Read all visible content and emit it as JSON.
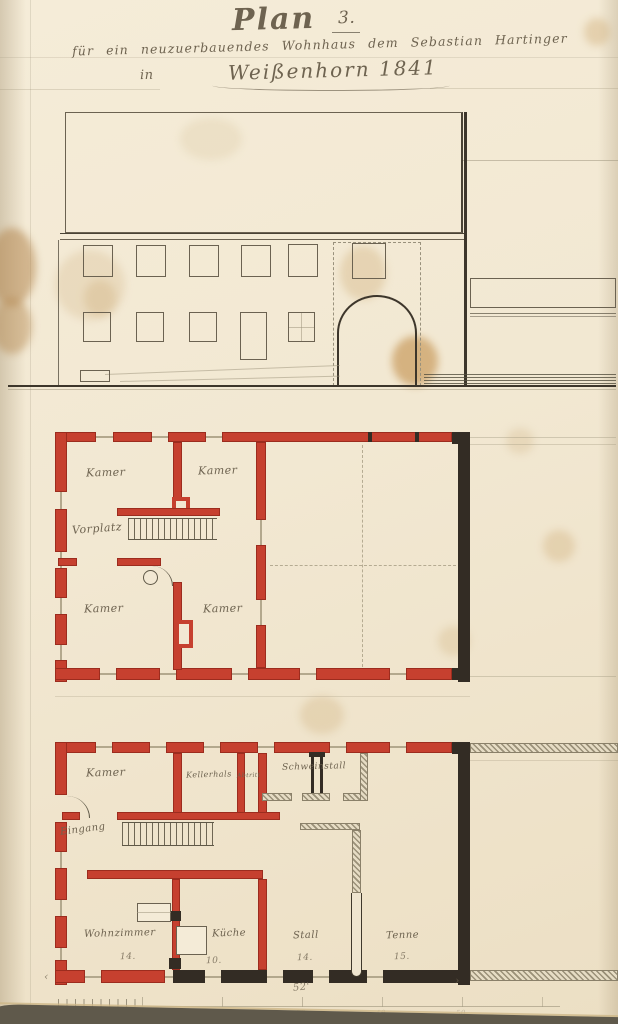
{
  "title": {
    "plan_word": "Plan",
    "plan_number": "3.",
    "subtitle": "für ein neuzuerbauendes Wohnhaus dem Sebastian Hartinger",
    "location_prefix": "in",
    "location": "Weißenhorn 1841"
  },
  "upper_floor_plan": {
    "rooms": {
      "kamer_nw": "Kamer",
      "kamer_ne": "Kamer",
      "vorplatz": "Vorplatz",
      "kamer_sw": "Kamer",
      "kamer_se": "Kamer"
    }
  },
  "ground_floor_plan": {
    "rooms": {
      "kamer": "Kamer",
      "kellerhals": "Kellerhals",
      "abtritt": "Abtritt",
      "schweinstall": "Schweinstall",
      "eingang": "Eingang",
      "wohnzimmer": "Wohnzimmer",
      "kueche": "Küche",
      "stall": "Stall",
      "tenne": "Tenne"
    },
    "dimensions": {
      "wohnzimmer": "14.",
      "kueche": "10.",
      "stall": "14.",
      "tenne": "15.",
      "total_width": "52'"
    },
    "dim_arrow_left": "‹",
    "dim_arrow_right": "›"
  },
  "scale_bar": {
    "tick_labels": [
      "10",
      "20",
      "30",
      "40",
      "50"
    ]
  },
  "colors": {
    "new_masonry_red": "#c6402f",
    "existing_masonry_black": "#332c24",
    "paper": "#f2e8d3",
    "ink": "#5a5243"
  }
}
